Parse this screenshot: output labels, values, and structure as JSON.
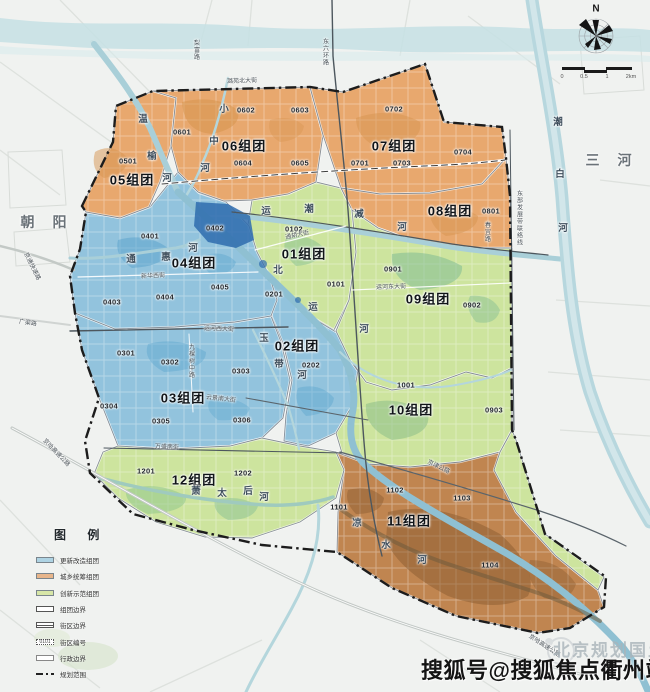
{
  "map": {
    "watermark": "搜狐号@搜狐焦点衢州站",
    "faint_watermark": "北京规划国土",
    "compass_n": "N",
    "scale_ticks": [
      {
        "t": "0",
        "x": 562
      },
      {
        "t": "0.5",
        "x": 584
      },
      {
        "t": "1",
        "x": 607
      },
      {
        "t": "2km",
        "x": 631
      }
    ]
  },
  "colors": {
    "blue_zone": "#92c3dd",
    "orange_zone": "#e8a86e",
    "green_zone": "#cde49e",
    "brown_zone": "#c08550",
    "deep_water": "#2e6cae",
    "boundary": "#1c1c1c"
  },
  "zones": [
    {
      "id": "01",
      "name": "01组团",
      "type": "green",
      "label": {
        "x": 304,
        "y": 253
      },
      "codes": [
        {
          "t": "0101",
          "x": 336,
          "y": 284
        },
        {
          "t": "0102",
          "x": 294,
          "y": 229
        }
      ]
    },
    {
      "id": "02",
      "name": "02组团",
      "type": "blue",
      "label": {
        "x": 297,
        "y": 345
      },
      "codes": [
        {
          "t": "0201",
          "x": 274,
          "y": 294
        },
        {
          "t": "0202",
          "x": 311,
          "y": 365
        }
      ]
    },
    {
      "id": "03",
      "name": "03组团",
      "type": "blue",
      "label": {
        "x": 183,
        "y": 397
      },
      "codes": [
        {
          "t": "0301",
          "x": 126,
          "y": 353
        },
        {
          "t": "0302",
          "x": 170,
          "y": 362
        },
        {
          "t": "0303",
          "x": 241,
          "y": 371
        },
        {
          "t": "0304",
          "x": 109,
          "y": 406
        },
        {
          "t": "0305",
          "x": 161,
          "y": 421
        },
        {
          "t": "0306",
          "x": 242,
          "y": 420
        }
      ]
    },
    {
      "id": "04",
      "name": "04组团",
      "type": "blue",
      "label": {
        "x": 194,
        "y": 262
      },
      "codes": [
        {
          "t": "0401",
          "x": 150,
          "y": 236
        },
        {
          "t": "0402",
          "x": 215,
          "y": 228
        },
        {
          "t": "0403",
          "x": 112,
          "y": 302
        },
        {
          "t": "0404",
          "x": 165,
          "y": 297
        },
        {
          "t": "0405",
          "x": 220,
          "y": 287
        }
      ]
    },
    {
      "id": "05",
      "name": "05组团",
      "type": "orange",
      "label": {
        "x": 132,
        "y": 179
      },
      "codes": [
        {
          "t": "0501",
          "x": 128,
          "y": 161
        }
      ]
    },
    {
      "id": "06",
      "name": "06组团",
      "type": "orange",
      "label": {
        "x": 244,
        "y": 145
      },
      "codes": [
        {
          "t": "0601",
          "x": 182,
          "y": 132
        },
        {
          "t": "0602",
          "x": 246,
          "y": 110
        },
        {
          "t": "0603",
          "x": 300,
          "y": 110
        },
        {
          "t": "0604",
          "x": 243,
          "y": 163
        },
        {
          "t": "0605",
          "x": 300,
          "y": 163
        }
      ]
    },
    {
      "id": "07",
      "name": "07组团",
      "type": "orange",
      "label": {
        "x": 394,
        "y": 145
      },
      "codes": [
        {
          "t": "0701",
          "x": 360,
          "y": 163
        },
        {
          "t": "0702",
          "x": 394,
          "y": 109
        },
        {
          "t": "0703",
          "x": 402,
          "y": 163
        },
        {
          "t": "0704",
          "x": 463,
          "y": 152
        }
      ]
    },
    {
      "id": "08",
      "name": "08组团",
      "type": "orange",
      "label": {
        "x": 450,
        "y": 210
      },
      "codes": [
        {
          "t": "0801",
          "x": 491,
          "y": 211
        }
      ]
    },
    {
      "id": "09",
      "name": "09组团",
      "type": "green",
      "label": {
        "x": 428,
        "y": 298
      },
      "codes": [
        {
          "t": "0901",
          "x": 393,
          "y": 269
        },
        {
          "t": "0902",
          "x": 472,
          "y": 305
        },
        {
          "t": "0903",
          "x": 494,
          "y": 410
        }
      ]
    },
    {
      "id": "10",
      "name": "10组团",
      "type": "green",
      "label": {
        "x": 411,
        "y": 409
      },
      "codes": [
        {
          "t": "1001",
          "x": 406,
          "y": 385
        }
      ]
    },
    {
      "id": "11",
      "name": "11组团",
      "type": "brown",
      "label": {
        "x": 409,
        "y": 520
      },
      "codes": [
        {
          "t": "1101",
          "x": 339,
          "y": 507
        },
        {
          "t": "1102",
          "x": 395,
          "y": 490
        },
        {
          "t": "1103",
          "x": 462,
          "y": 498
        },
        {
          "t": "1104",
          "x": 490,
          "y": 565
        }
      ]
    },
    {
      "id": "12",
      "name": "12组团",
      "type": "green",
      "label": {
        "x": 194,
        "y": 479
      },
      "codes": [
        {
          "t": "1201",
          "x": 146,
          "y": 471
        },
        {
          "t": "1202",
          "x": 243,
          "y": 473
        }
      ]
    }
  ],
  "rivers": [
    {
      "name": "温榆河",
      "chars": [
        {
          "c": "温",
          "x": 143,
          "y": 118
        },
        {
          "c": "榆",
          "x": 152,
          "y": 155
        },
        {
          "c": "河",
          "x": 167,
          "y": 177
        }
      ]
    },
    {
      "name": "小中河",
      "chars": [
        {
          "c": "小",
          "x": 224,
          "y": 108
        },
        {
          "c": "中",
          "x": 214,
          "y": 140
        },
        {
          "c": "河",
          "x": 205,
          "y": 167
        }
      ]
    },
    {
      "name": "潮白河",
      "chars": [
        {
          "c": "潮",
          "x": 558,
          "y": 121
        },
        {
          "c": "白",
          "x": 560,
          "y": 173
        },
        {
          "c": "河",
          "x": 563,
          "y": 227
        }
      ]
    },
    {
      "name": "运潮减河",
      "chars": [
        {
          "c": "运",
          "x": 266,
          "y": 210
        },
        {
          "c": "潮",
          "x": 309,
          "y": 208
        },
        {
          "c": "减",
          "x": 359,
          "y": 213
        },
        {
          "c": "河",
          "x": 402,
          "y": 226
        }
      ]
    },
    {
      "name": "北运河",
      "chars": [
        {
          "c": "北",
          "x": 278,
          "y": 269
        },
        {
          "c": "运",
          "x": 313,
          "y": 306
        },
        {
          "c": "河",
          "x": 364,
          "y": 328
        }
      ]
    },
    {
      "name": "玉带河",
      "chars": [
        {
          "c": "玉",
          "x": 264,
          "y": 337
        },
        {
          "c": "带",
          "x": 279,
          "y": 363
        },
        {
          "c": "河",
          "x": 302,
          "y": 374
        }
      ]
    },
    {
      "name": "通惠河",
      "chars": [
        {
          "c": "通",
          "x": 131,
          "y": 258
        },
        {
          "c": "惠",
          "x": 166,
          "y": 256
        },
        {
          "c": "河",
          "x": 193,
          "y": 247
        }
      ]
    },
    {
      "name": "萧太后河",
      "chars": [
        {
          "c": "萧",
          "x": 196,
          "y": 490
        },
        {
          "c": "太",
          "x": 222,
          "y": 492
        },
        {
          "c": "后",
          "x": 248,
          "y": 490
        },
        {
          "c": "河",
          "x": 264,
          "y": 496
        }
      ]
    },
    {
      "name": "凉水河",
      "chars": [
        {
          "c": "凉",
          "x": 357,
          "y": 522
        },
        {
          "c": "水",
          "x": 386,
          "y": 544
        },
        {
          "c": "河",
          "x": 422,
          "y": 559
        }
      ]
    }
  ],
  "roads": [
    {
      "t": "潞苑北大街",
      "x": 242,
      "y": 80,
      "rot": -2
    },
    {
      "t": "梨富路",
      "x": 196,
      "y": 50,
      "vert": true
    },
    {
      "t": "东六环路",
      "x": 325,
      "y": 52,
      "vert": true
    },
    {
      "t": "京通快速路",
      "x": 33,
      "y": 266,
      "rot": 64
    },
    {
      "t": "广渠路",
      "x": 28,
      "y": 322,
      "rot": 8
    },
    {
      "t": "新华西街",
      "x": 153,
      "y": 275,
      "rot": -3
    },
    {
      "t": "运河西大街",
      "x": 219,
      "y": 328,
      "rot": 2
    },
    {
      "t": "九棵树中路",
      "x": 191,
      "y": 361,
      "vert": true
    },
    {
      "t": "云景南大街",
      "x": 221,
      "y": 398,
      "rot": 6
    },
    {
      "t": "万盛南街",
      "x": 167,
      "y": 446,
      "rot": 2
    },
    {
      "t": "通胡大街",
      "x": 297,
      "y": 234,
      "rot": -12
    },
    {
      "t": "运河东大街",
      "x": 391,
      "y": 286,
      "rot": -2
    },
    {
      "t": "京津公路",
      "x": 439,
      "y": 466,
      "rot": 26
    },
    {
      "t": "京哈高速公路",
      "x": 57,
      "y": 452,
      "rot": 46
    },
    {
      "t": "京哈高速公路",
      "x": 545,
      "y": 645,
      "rot": 33
    },
    {
      "t": "东部发展带联络线",
      "x": 519,
      "y": 218,
      "vert": true
    },
    {
      "t": "春宜路",
      "x": 487,
      "y": 232,
      "vert": true
    }
  ],
  "places": [
    {
      "t": "朝 阳",
      "x": 47,
      "y": 222
    },
    {
      "t": "三 河",
      "x": 612,
      "y": 160
    }
  ],
  "legend": {
    "title": "图 例",
    "items": [
      {
        "label": "更新改造组团",
        "kind": "fill",
        "swatch": "#aed3e3"
      },
      {
        "label": "城乡统筹组团",
        "kind": "fill",
        "swatch": "#e7b58b"
      },
      {
        "label": "创新示范组团",
        "kind": "fill",
        "swatch": "#d7e6a7"
      },
      {
        "label": "组团边界",
        "kind": "box"
      },
      {
        "label": "街区边界",
        "kind": "box2"
      },
      {
        "label": "街区编号",
        "kind": "code",
        "sample": "0101"
      },
      {
        "label": "行政边界",
        "kind": "box3"
      },
      {
        "label": "规划范围",
        "kind": "dashdot"
      }
    ]
  }
}
